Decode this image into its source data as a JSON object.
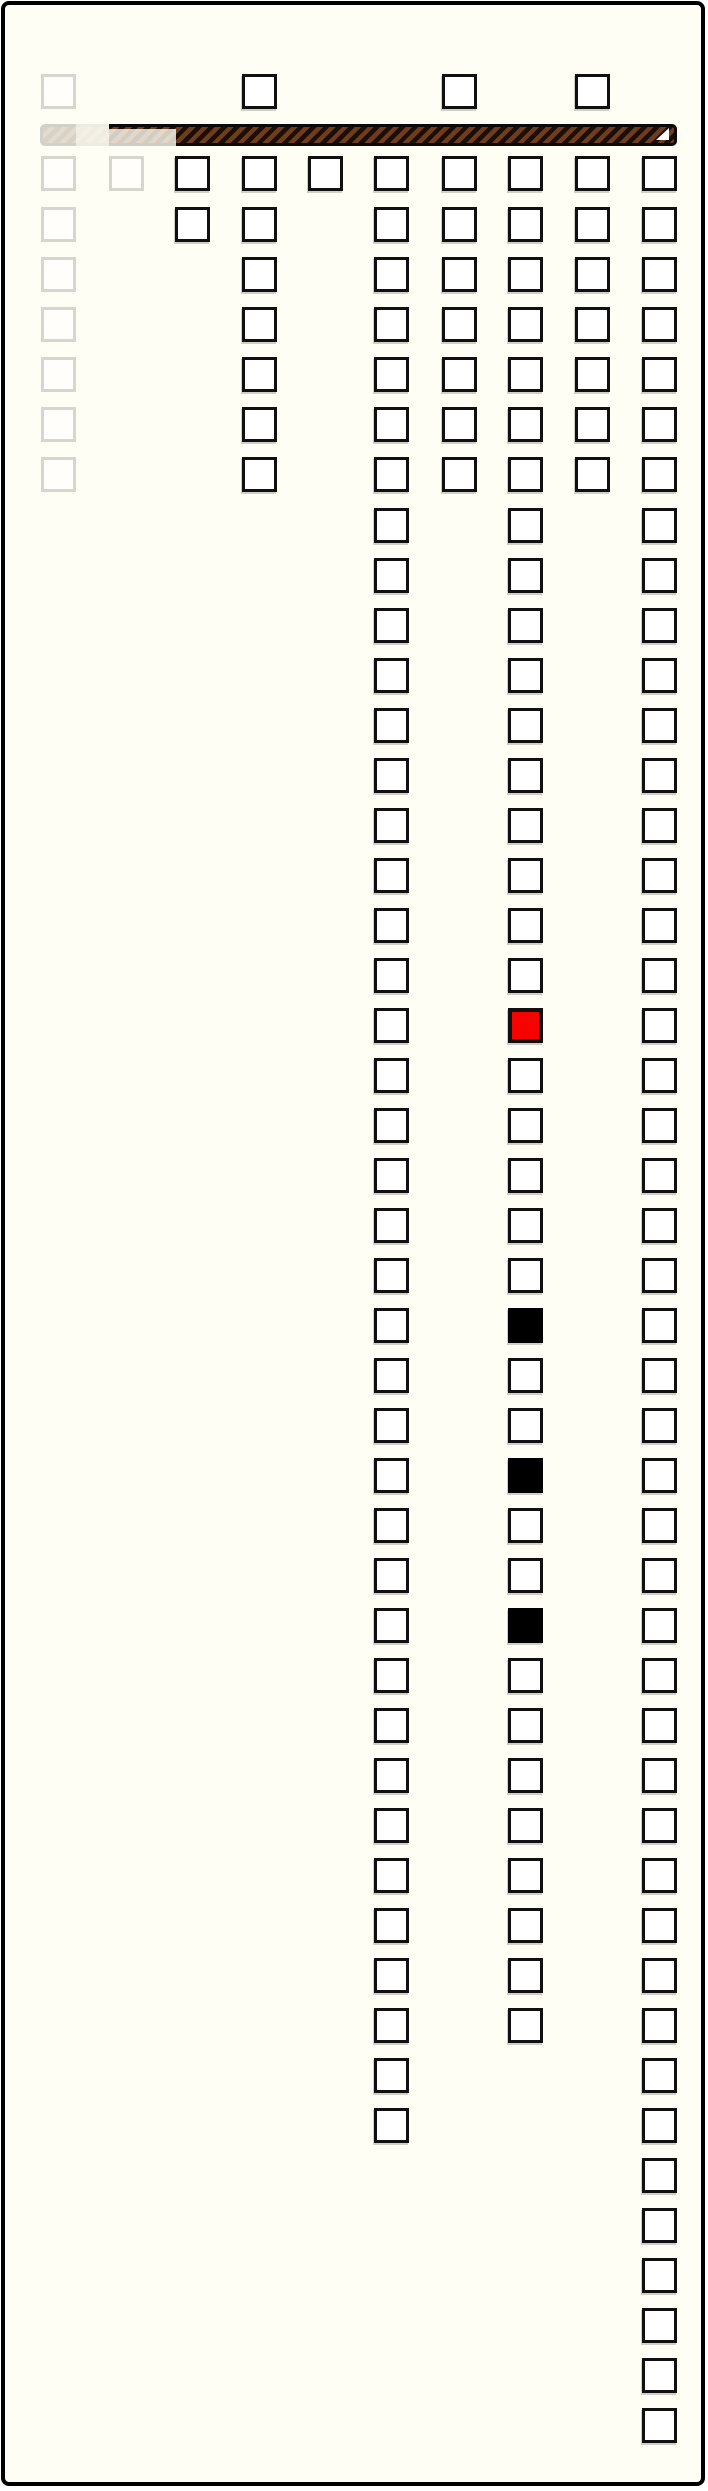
{
  "page": {
    "width": 708,
    "height": 2491,
    "background": "#fffef4",
    "border_color": "#000000"
  },
  "progress_bar": {
    "x": 35,
    "y": 119,
    "width": 637,
    "height": 22,
    "stripe_dark": "#1b0e05",
    "stripe_brown": "#6f3c1e",
    "stripe_width": 4.5,
    "notch_color": "#ffffff",
    "fades": [
      {
        "x": 35,
        "y": 117,
        "w": 36,
        "h": 26,
        "opacity": 0.82
      },
      {
        "x": 71,
        "y": 117,
        "w": 33,
        "h": 26,
        "opacity": 0.93
      },
      {
        "x": 104,
        "y": 124,
        "w": 67,
        "h": 19,
        "opacity": 0.8
      }
    ],
    "border_fade": {
      "x": 0,
      "y": 36,
      "w": 10,
      "h": 483,
      "opacity": 0.85
    }
  },
  "board": {
    "square_size": 35,
    "colors": {
      "outline": "#101010",
      "fill": "#ffffff",
      "faded_outline": "#d6d6cf",
      "red_fill": "#f60300",
      "black_fill": "#000000"
    },
    "top_rows_y": [
      69,
      151,
      202,
      252,
      302,
      352,
      402,
      452
    ],
    "long_start_y": 503,
    "row_pitch": 50,
    "columns": [
      {
        "name": "col-1",
        "x": 36,
        "variant": "faded",
        "top_rows": [
          1,
          2,
          3,
          4,
          5,
          6,
          7,
          8
        ],
        "long_count": 0
      },
      {
        "name": "col-2",
        "x": 104,
        "variant": "faded",
        "top_rows": [
          2
        ],
        "long_count": 0
      },
      {
        "name": "col-3",
        "x": 170,
        "variant": "normal",
        "top_rows": [
          2,
          3
        ],
        "long_count": 0
      },
      {
        "name": "col-4",
        "x": 237,
        "variant": "normal",
        "top_rows": [
          1,
          2,
          3,
          4,
          5,
          6,
          7,
          8
        ],
        "long_count": 0
      },
      {
        "name": "col-5",
        "x": 303,
        "variant": "normal",
        "top_rows": [
          2
        ],
        "long_count": 0
      },
      {
        "name": "col-6",
        "x": 369,
        "variant": "normal",
        "top_rows": [
          2,
          3,
          4,
          5,
          6,
          7,
          8
        ],
        "long_count": 33
      },
      {
        "name": "col-7",
        "x": 437,
        "variant": "normal",
        "top_rows": [
          1,
          2,
          3,
          4,
          5,
          6,
          7,
          8
        ],
        "long_count": 0
      },
      {
        "name": "col-8",
        "x": 503,
        "variant": "normal",
        "top_rows": [
          2,
          3,
          4,
          5,
          6,
          7,
          8
        ],
        "long_count": 31,
        "specials": {
          "10": "red",
          "16": "black",
          "19": "black",
          "22": "black"
        }
      },
      {
        "name": "col-9",
        "x": 570,
        "variant": "normal",
        "top_rows": [
          1,
          2,
          3,
          4,
          5,
          6,
          7,
          8
        ],
        "long_count": 0
      },
      {
        "name": "col-10",
        "x": 637,
        "variant": "normal",
        "top_rows": [
          2,
          3,
          4,
          5,
          6,
          7,
          8
        ],
        "long_count": 39
      }
    ]
  }
}
